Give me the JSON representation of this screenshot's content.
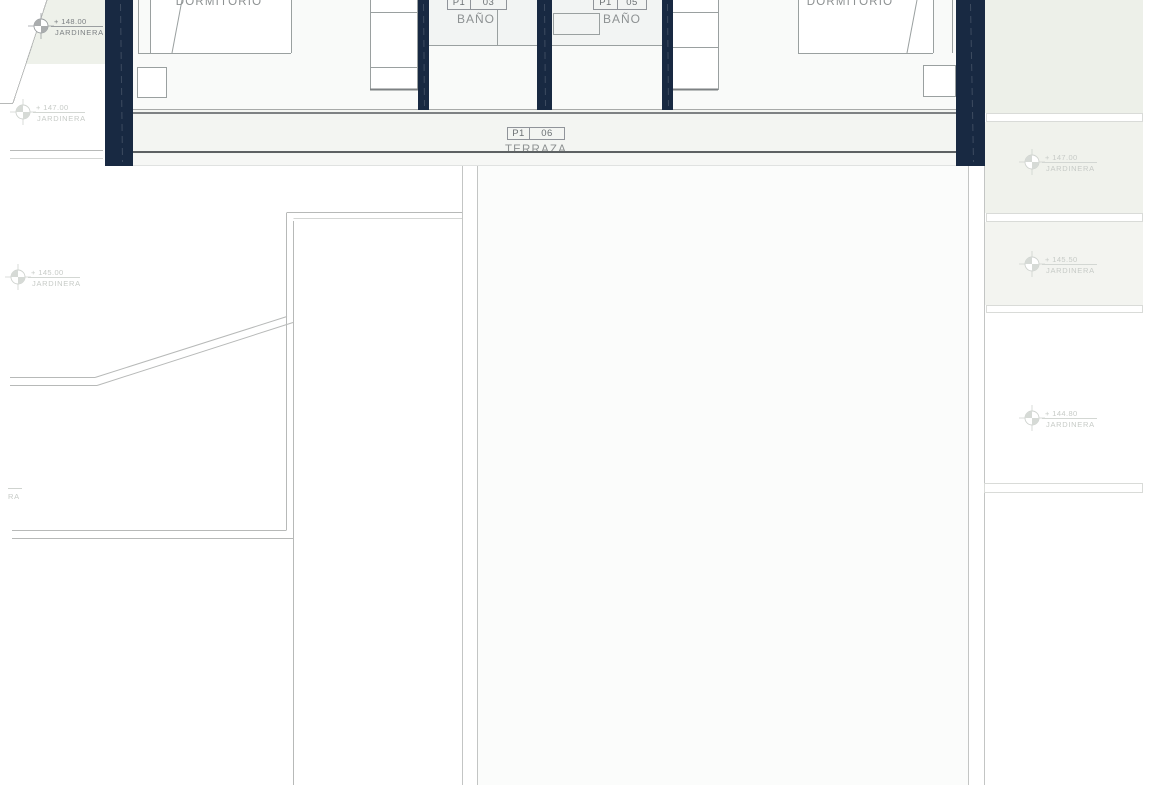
{
  "plan": {
    "title": "first floor plan (cropped view)",
    "rooms": {
      "dormitorio_left": "DORMITORIO",
      "bano_left": "BAÑO",
      "bano_right": "BAÑO",
      "dormitorio_right": "DORMITORIO",
      "terraza": "TERRAZA"
    },
    "tags": {
      "bano_left": {
        "unit": "P1",
        "num": "03"
      },
      "bano_right": {
        "unit": "P1",
        "num": "05"
      },
      "terraza": {
        "unit": "P1",
        "num": "06"
      }
    },
    "markers": {
      "left_148": {
        "value": "+ 148.00",
        "label": "JARDINERA"
      },
      "left_147": {
        "value": "+ 147.00",
        "label": "JARDINERA"
      },
      "left_145": {
        "value": "+ 145.00",
        "label": "JARDINERA"
      },
      "right_147": {
        "value": "+ 147.00",
        "label": "JARDINERA"
      },
      "right_145_50": {
        "value": "+ 145.50",
        "label": "JARDINERA"
      },
      "right_144_80": {
        "value": "+ 144.80",
        "label": "JARDINERA"
      },
      "left_edge_fragment": {
        "label": "RA"
      }
    },
    "colors": {
      "wall_navy": "#182942",
      "garden_green": "#edf0e9",
      "terrace_fill": "#f3f5f2",
      "line_gray": "#b7b9b8",
      "dark_edge_line": "#5d6163",
      "label_gray": "#8d9192",
      "marker_light_gray": "#c7cbc7"
    }
  }
}
